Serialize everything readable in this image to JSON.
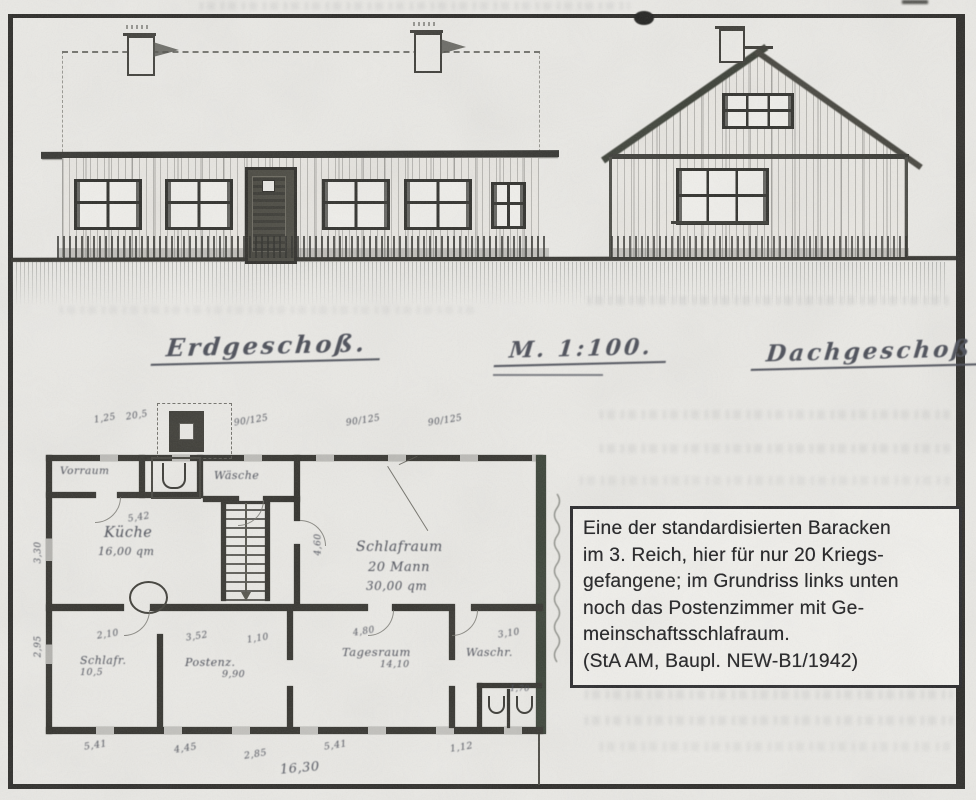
{
  "titles": {
    "erdgeschoss": "Erdgeschoß.",
    "massstab": "M. 1:100.",
    "dachgeschoss": "Dachgeschoß"
  },
  "caption": {
    "lines": [
      "Eine der standardisierten Baracken",
      "im 3. Reich, hier für nur 20 Kriegs-",
      "gefangene; im Grundriss links unten",
      "noch das Postenzimmer mit Ge-",
      "meinschaftsschlafraum.",
      "(StA AM, Baupl. NEW-B1/1942)"
    ]
  },
  "floorplan": {
    "rooms": {
      "vorraum": "Vorraum",
      "waesche": "Wäsche",
      "kueche_name": "Küche",
      "kueche_area": "16,00 qm",
      "schlafraum_name": "Schlafraum",
      "schlafraum_capacity": "20 Mann",
      "schlafraum_area": "30,00 qm",
      "schlafr_name": "Schlafr.",
      "schlafr_area": "10,5",
      "posten_name": "Postenz.",
      "posten_area": "9,90",
      "tagesraum_name": "Tagesraum",
      "tagesraum_area": "14,10",
      "waschraum_name": "Waschr."
    },
    "dims_top": [
      "1,25",
      "20,5",
      "90/125",
      "90/125",
      "90/125"
    ],
    "dims_inner": {
      "kueche_breite": "5,42",
      "schlafraum_hoehe": "4,60",
      "schlafr": "2,10",
      "posten": "3,52",
      "flur": "1,10",
      "tagesraum": "4,80",
      "waschraum": "3,10",
      "abort": "1,70"
    },
    "dims_left": [
      "3,30",
      "2,95"
    ],
    "dims_bottom": [
      "5,41",
      "4,45",
      "2,85",
      "5,41",
      "1,12"
    ],
    "dim_total": "16,30"
  },
  "colors": {
    "paper": "#eae9e5",
    "print_ink": "#222224",
    "hand_ink": "#4a4d57",
    "wall": "#34332e",
    "wall_olive": "#3a4237"
  }
}
